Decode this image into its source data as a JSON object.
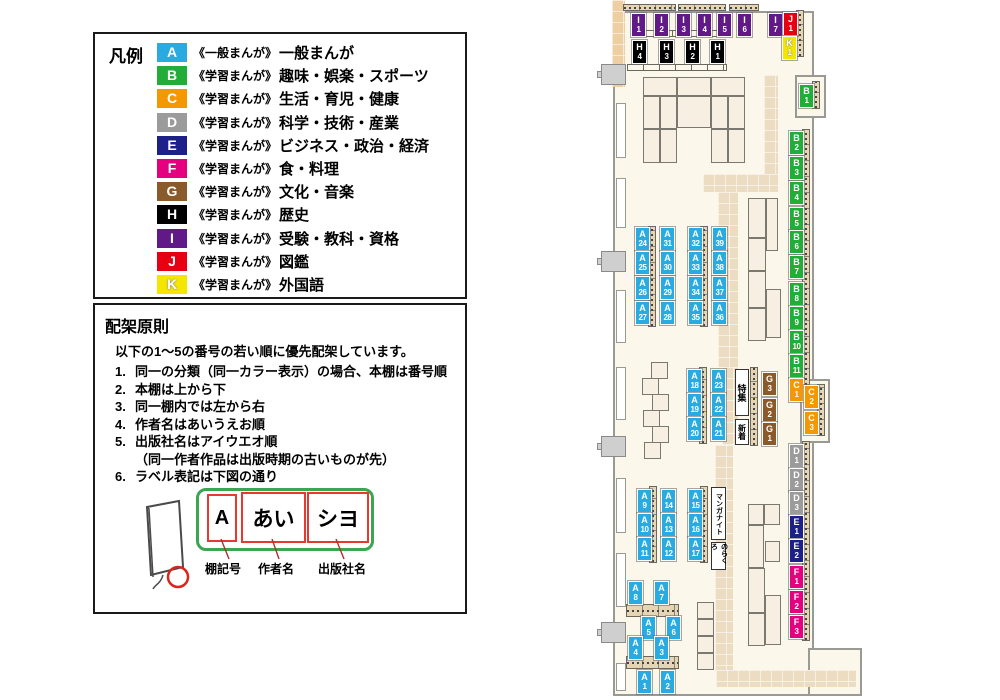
{
  "legend": {
    "title": "凡例",
    "items": [
      {
        "code": "A",
        "type": "《一般まんが》",
        "category": "一般まんが"
      },
      {
        "code": "B",
        "type": "《学習まんが》",
        "category": "趣味・娯楽・スポーツ"
      },
      {
        "code": "C",
        "type": "《学習まんが》",
        "category": "生活・育児・健康"
      },
      {
        "code": "D",
        "type": "《学習まんが》",
        "category": "科学・技術・産業"
      },
      {
        "code": "E",
        "type": "《学習まんが》",
        "category": "ビジネス・政治・経済"
      },
      {
        "code": "F",
        "type": "《学習まんが》",
        "category": "食・料理"
      },
      {
        "code": "G",
        "type": "《学習まんが》",
        "category": "文化・音楽"
      },
      {
        "code": "H",
        "type": "《学習まんが》",
        "category": "歴史"
      },
      {
        "code": "I",
        "type": "《学習まんが》",
        "category": "受験・教科・資格"
      },
      {
        "code": "J",
        "type": "《学習まんが》",
        "category": "図鑑"
      },
      {
        "code": "K",
        "type": "《学習まんが》",
        "category": "外国語"
      }
    ]
  },
  "colors": {
    "A": "#29abe2",
    "B": "#22ac38",
    "C": "#f39800",
    "D": "#9b9b9b",
    "E": "#1d2088",
    "F": "#e4007f",
    "G": "#8a5a2a",
    "H": "#000000",
    "I": "#601986",
    "J": "#e60012",
    "K": "#f5e600"
  },
  "rules": {
    "title": "配架原則",
    "intro": "以下の1～5の番号の若い順に優先配架しています。",
    "items": [
      {
        "num": "1.",
        "text": "同一の分類（同一カラー表示）の場合、本棚は番号順",
        "cont": false
      },
      {
        "num": "2.",
        "text": "本棚は上から下",
        "cont": false
      },
      {
        "num": "3.",
        "text": "同一棚内では左から右",
        "cont": false
      },
      {
        "num": "4.",
        "text": "作者名はあいうえお順",
        "cont": false
      },
      {
        "num": "5.",
        "text": "出版社名はアイウエオ順",
        "cont": false
      },
      {
        "num": "",
        "text": "（同一作者作品は出版時期の古いものが先）",
        "cont": true
      },
      {
        "num": "6.",
        "text": "ラベル表記は下図の通り",
        "cont": false
      }
    ],
    "diagram": {
      "shelf_code": "A",
      "author": "あい",
      "publisher": "シヨ",
      "captions": [
        "棚記号",
        "作者名",
        "出版社名"
      ]
    }
  },
  "map": {
    "shelf_labels": [
      {
        "id": "I1",
        "x": 631,
        "y": 13
      },
      {
        "id": "I2",
        "x": 654,
        "y": 13
      },
      {
        "id": "I3",
        "x": 676,
        "y": 13
      },
      {
        "id": "I4",
        "x": 697,
        "y": 13
      },
      {
        "id": "I5",
        "x": 717,
        "y": 13
      },
      {
        "id": "I6",
        "x": 737,
        "y": 13
      },
      {
        "id": "I7",
        "x": 768,
        "y": 13
      },
      {
        "id": "J1",
        "x": 783,
        "y": 12
      },
      {
        "id": "K1",
        "x": 782,
        "y": 36
      },
      {
        "id": "H4",
        "x": 632,
        "y": 40
      },
      {
        "id": "H3",
        "x": 659,
        "y": 40
      },
      {
        "id": "H2",
        "x": 685,
        "y": 40
      },
      {
        "id": "H1",
        "x": 710,
        "y": 40
      },
      {
        "id": "B1",
        "x": 799,
        "y": 84
      },
      {
        "id": "B2",
        "x": 789,
        "y": 131
      },
      {
        "id": "B3",
        "x": 789,
        "y": 156
      },
      {
        "id": "B4",
        "x": 789,
        "y": 181
      },
      {
        "id": "B5",
        "x": 789,
        "y": 207
      },
      {
        "id": "B6",
        "x": 789,
        "y": 230
      },
      {
        "id": "B7",
        "x": 789,
        "y": 255
      },
      {
        "id": "B8",
        "x": 789,
        "y": 282
      },
      {
        "id": "B9",
        "x": 789,
        "y": 306
      },
      {
        "id": "B10",
        "x": 789,
        "y": 330
      },
      {
        "id": "B11",
        "x": 789,
        "y": 354
      },
      {
        "id": "C1",
        "x": 789,
        "y": 378
      },
      {
        "id": "C2",
        "x": 804,
        "y": 385
      },
      {
        "id": "C3",
        "x": 804,
        "y": 411
      },
      {
        "id": "D1",
        "x": 789,
        "y": 444
      },
      {
        "id": "D2",
        "x": 789,
        "y": 468
      },
      {
        "id": "D3",
        "x": 789,
        "y": 491
      },
      {
        "id": "E1",
        "x": 789,
        "y": 515
      },
      {
        "id": "E2",
        "x": 789,
        "y": 539
      },
      {
        "id": "F1",
        "x": 789,
        "y": 565
      },
      {
        "id": "F2",
        "x": 789,
        "y": 590
      },
      {
        "id": "F3",
        "x": 789,
        "y": 615
      },
      {
        "id": "G3",
        "x": 762,
        "y": 372
      },
      {
        "id": "G2",
        "x": 762,
        "y": 398
      },
      {
        "id": "G1",
        "x": 762,
        "y": 422
      },
      {
        "id": "A24",
        "x": 635,
        "y": 227
      },
      {
        "id": "A25",
        "x": 635,
        "y": 251
      },
      {
        "id": "A26",
        "x": 635,
        "y": 276
      },
      {
        "id": "A27",
        "x": 635,
        "y": 301
      },
      {
        "id": "A31",
        "x": 660,
        "y": 227
      },
      {
        "id": "A30",
        "x": 660,
        "y": 251
      },
      {
        "id": "A29",
        "x": 660,
        "y": 276
      },
      {
        "id": "A28",
        "x": 660,
        "y": 301
      },
      {
        "id": "A32",
        "x": 688,
        "y": 227
      },
      {
        "id": "A33",
        "x": 688,
        "y": 251
      },
      {
        "id": "A34",
        "x": 688,
        "y": 276
      },
      {
        "id": "A35",
        "x": 688,
        "y": 301
      },
      {
        "id": "A39",
        "x": 712,
        "y": 227
      },
      {
        "id": "A38",
        "x": 712,
        "y": 251
      },
      {
        "id": "A37",
        "x": 712,
        "y": 276
      },
      {
        "id": "A36",
        "x": 712,
        "y": 301
      },
      {
        "id": "A18",
        "x": 687,
        "y": 369
      },
      {
        "id": "A19",
        "x": 687,
        "y": 393
      },
      {
        "id": "A20",
        "x": 687,
        "y": 417
      },
      {
        "id": "A23",
        "x": 711,
        "y": 369
      },
      {
        "id": "A22",
        "x": 711,
        "y": 393
      },
      {
        "id": "A21",
        "x": 711,
        "y": 417
      },
      {
        "id": "A9",
        "x": 637,
        "y": 489
      },
      {
        "id": "A10",
        "x": 637,
        "y": 513
      },
      {
        "id": "A11",
        "x": 637,
        "y": 537
      },
      {
        "id": "A14",
        "x": 661,
        "y": 489
      },
      {
        "id": "A13",
        "x": 661,
        "y": 513
      },
      {
        "id": "A12",
        "x": 661,
        "y": 537
      },
      {
        "id": "A15",
        "x": 688,
        "y": 489
      },
      {
        "id": "A16",
        "x": 688,
        "y": 513
      },
      {
        "id": "A17",
        "x": 688,
        "y": 537
      },
      {
        "id": "A8",
        "x": 628,
        "y": 581
      },
      {
        "id": "A7",
        "x": 654,
        "y": 581
      },
      {
        "id": "A5",
        "x": 641,
        "y": 616
      },
      {
        "id": "A6",
        "x": 666,
        "y": 616
      },
      {
        "id": "A4",
        "x": 628,
        "y": 636
      },
      {
        "id": "A3",
        "x": 654,
        "y": 636
      },
      {
        "id": "A1",
        "x": 637,
        "y": 670
      },
      {
        "id": "A2",
        "x": 660,
        "y": 670
      }
    ],
    "area_labels": [
      {
        "text": "特集",
        "x": 735,
        "y": 369,
        "w": 14,
        "h": 47,
        "fs": 9
      },
      {
        "text": "新着",
        "x": 735,
        "y": 419,
        "w": 14,
        "h": 26,
        "fs": 8
      },
      {
        "text": "マンガナイト",
        "x": 711,
        "y": 487,
        "w": 15,
        "h": 53,
        "fs": 7
      },
      {
        "text": "のらくろ",
        "x": 711,
        "y": 542,
        "w": 15,
        "h": 28,
        "fs": 7
      }
    ]
  }
}
